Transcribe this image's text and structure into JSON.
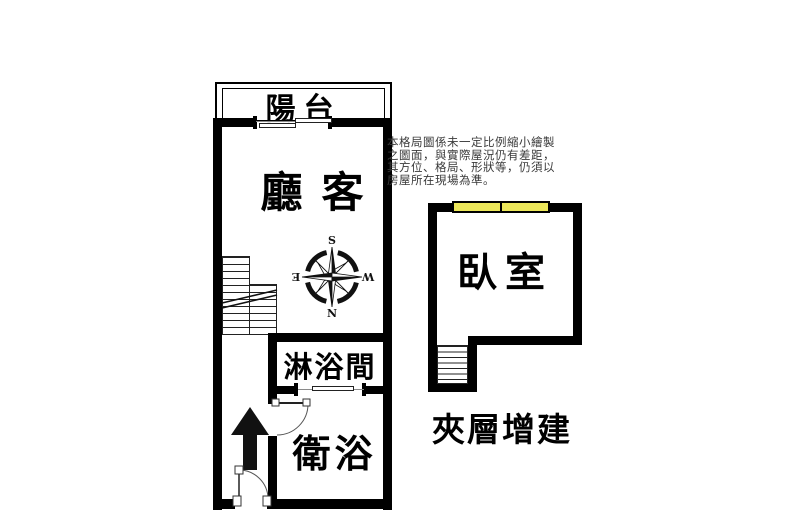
{
  "rooms": {
    "balcony": "陽台",
    "living_room": "客廳",
    "shower_room": "淋浴間",
    "bathroom": "衛浴",
    "bedroom": "臥室"
  },
  "labels": {
    "mezzanine_addition": "夾層增建"
  },
  "compass": {
    "north": "N",
    "south": "S",
    "east": "E",
    "west": "W"
  },
  "disclaimer": {
    "lines": [
      "本格局圖係未一定比例縮小繪製",
      "之圖面，與實際屋況仍有差距，",
      "其方位、格局、形狀等，仍須以",
      "房屋所在現場為準。"
    ]
  },
  "colors": {
    "wall": "#000000",
    "window_fill": "#ECE75A",
    "background": "#FFFFFF",
    "disclaimer_text": "#3A3A3A"
  }
}
